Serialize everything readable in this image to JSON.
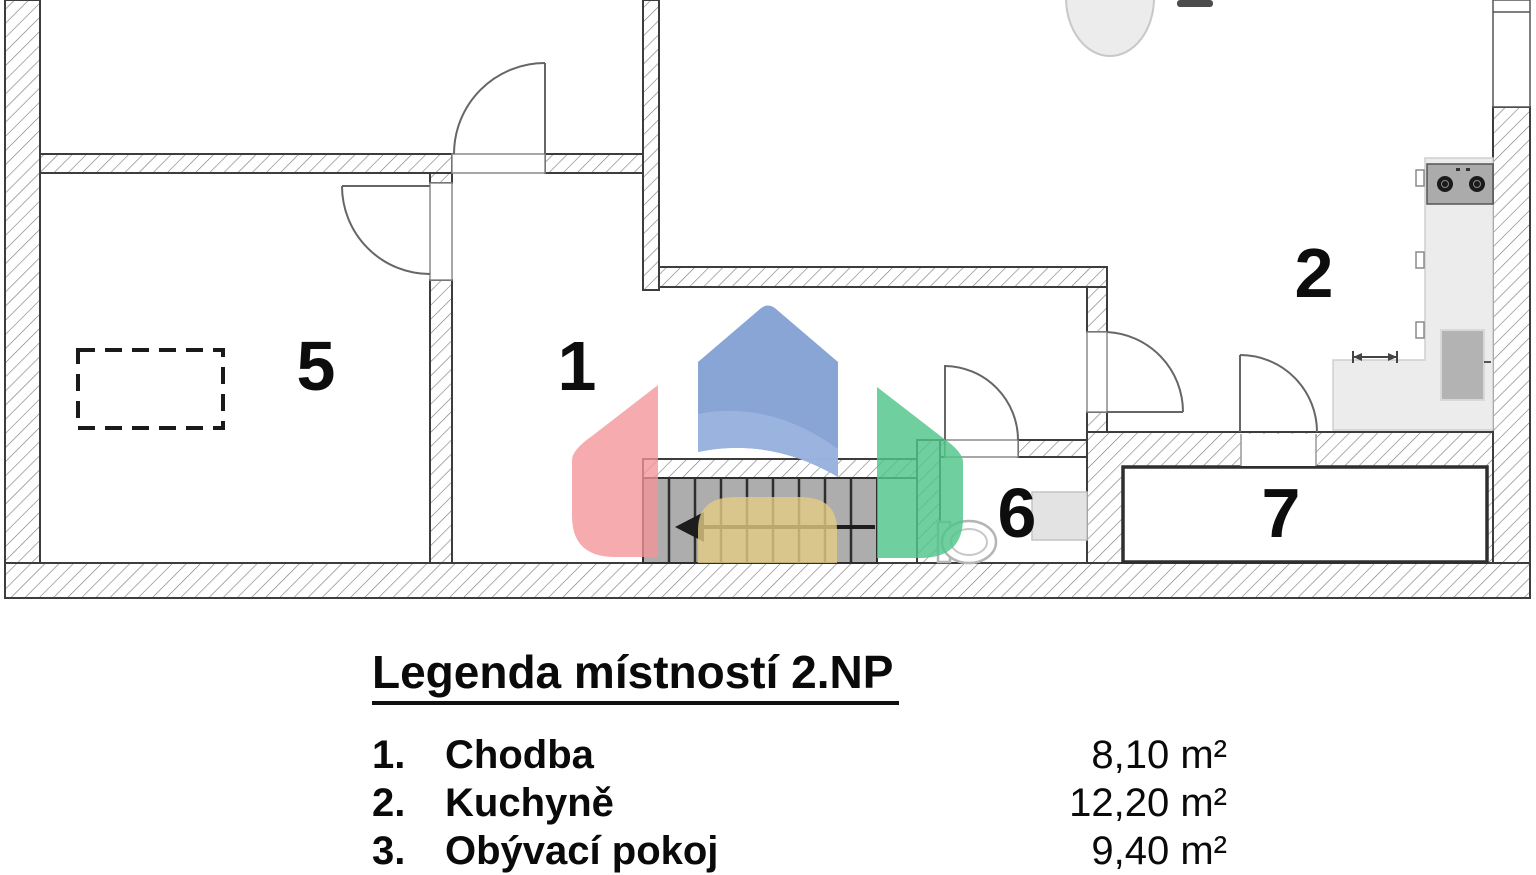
{
  "rooms": {
    "r1": "1",
    "r2": "2",
    "r5": "5",
    "r6": "6",
    "r7": "7"
  },
  "legend": {
    "title": "Legenda místností 2.NP",
    "rows": [
      {
        "num": "1.",
        "name": "Chodba",
        "area": "8,10 m²"
      },
      {
        "num": "2.",
        "name": "Kuchyně",
        "area": "12,20 m²"
      },
      {
        "num": "3.",
        "name": "Obývací pokoj",
        "area": "9,40 m²"
      }
    ]
  },
  "colors": {
    "watermark_red": "#f49598",
    "watermark_blue": "#7b9bd2",
    "watermark_blue_light": "#9fb6e0",
    "watermark_green": "#4fc58a",
    "watermark_yellow": "#e2cc83"
  }
}
